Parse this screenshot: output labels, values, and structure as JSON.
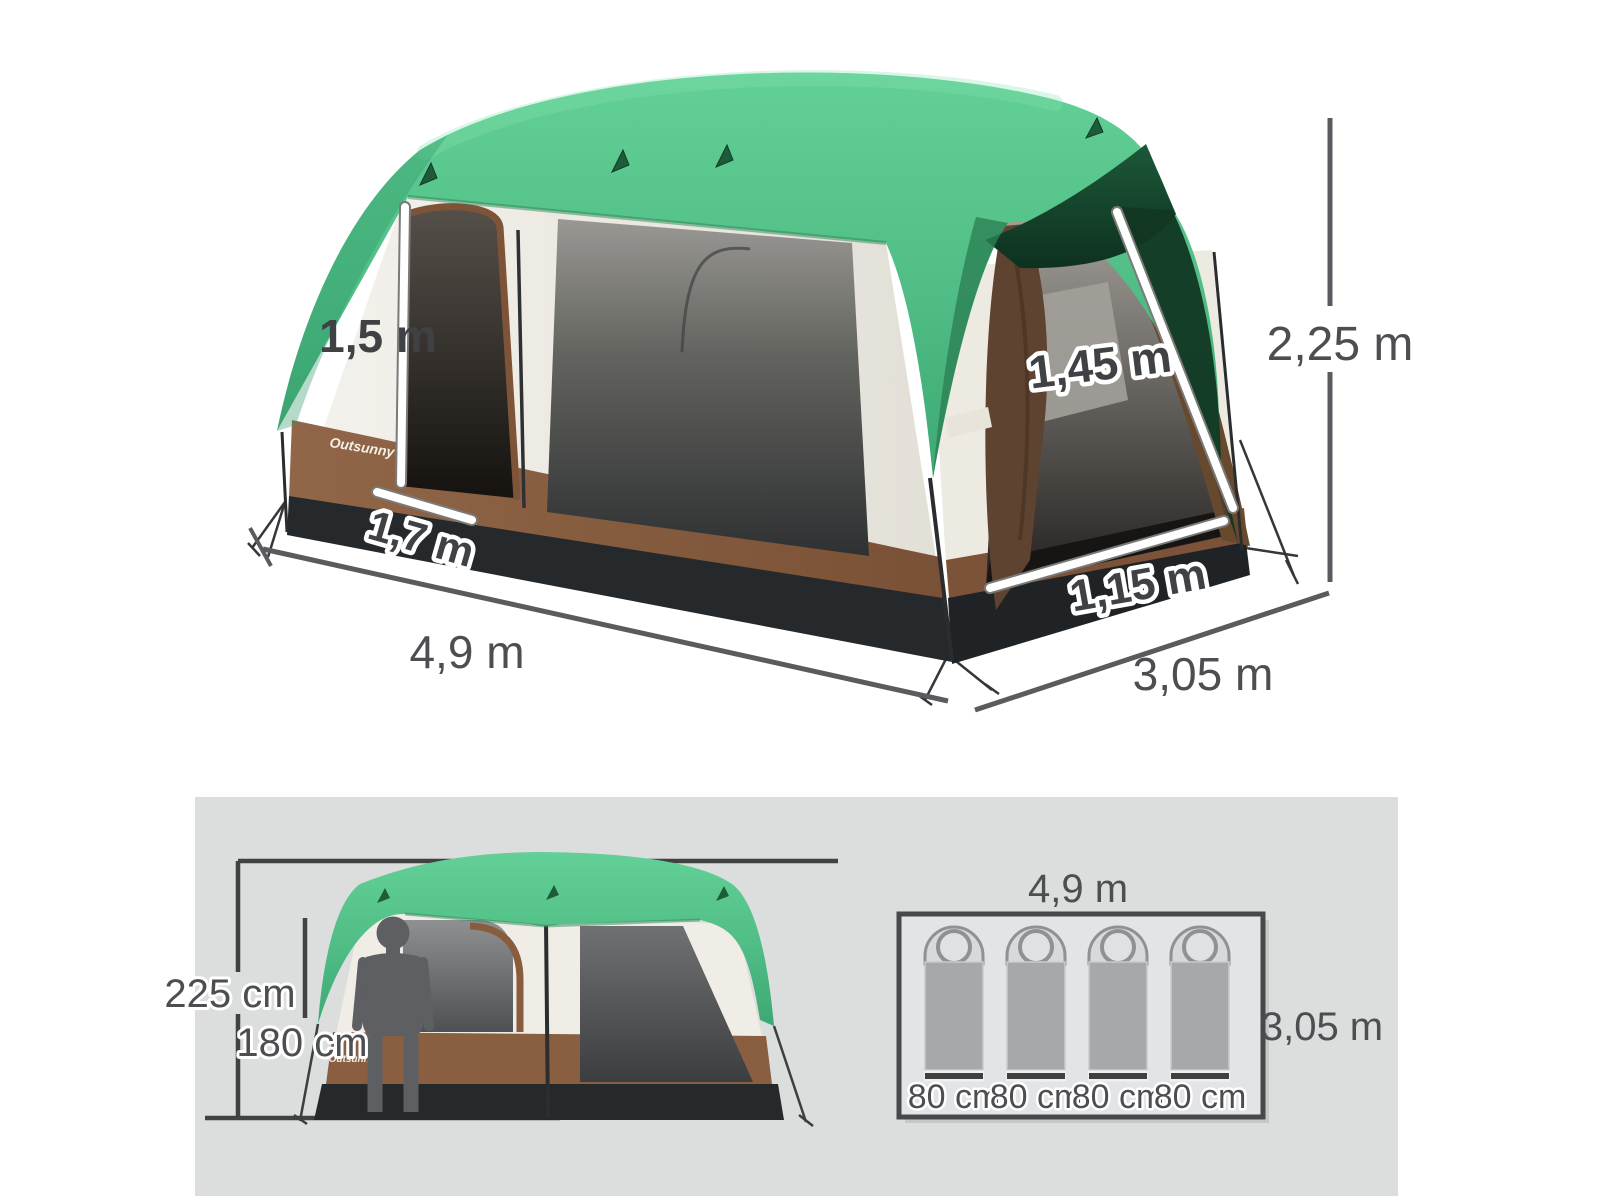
{
  "top_view": {
    "brand": "Outsunny",
    "labels": {
      "left_door_height": "1,5 m",
      "left_door_width": "1,7 m",
      "right_door_height": "1,45 m",
      "right_door_width": "1,15 m",
      "height": "2,25 m",
      "length": "4,9 m",
      "depth": "3,05 m"
    }
  },
  "front_view": {
    "brand": "Outsunny",
    "labels": {
      "height": "225 cm",
      "person_height": "180 cm"
    }
  },
  "floor_plan": {
    "labels": {
      "length": "4,9 m",
      "depth": "3,05 m"
    },
    "bags": [
      {
        "width": "80 cm"
      },
      {
        "width": "80 cm"
      },
      {
        "width": "80 cm"
      },
      {
        "width": "80 cm"
      }
    ]
  },
  "colors": {
    "roof_green": "#54c28a",
    "roof_shade_green": "#14402a",
    "wall_cream": "#f1efe8",
    "band_brown": "#8a5f41",
    "curtain_brown": "#5e4732",
    "base_black": "#26292b",
    "panel_gray": "#dcdddd",
    "dim_text": "#4c4e51",
    "dim_line": "#55575a"
  }
}
